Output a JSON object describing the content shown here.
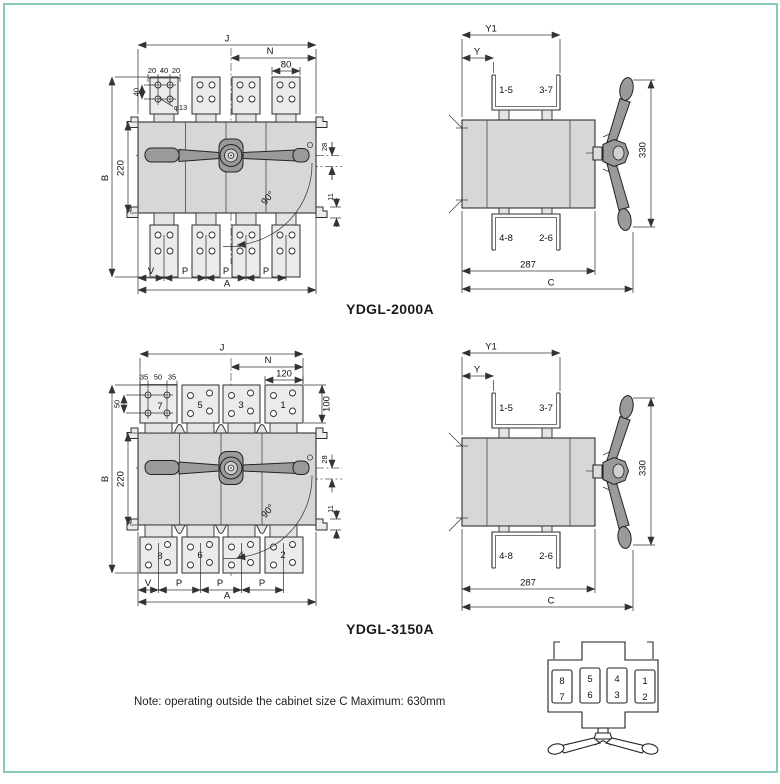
{
  "colors": {
    "frame": "#85cbb5",
    "body_fill": "#d7d7d7",
    "pad_fill": "#ebebeb",
    "handle_fill": "#9a9a9a",
    "line": "#333333"
  },
  "note": "Note: operating outside the cabinet size C Maximum: 630mm",
  "model_2000a": {
    "title": "YDGL-2000A",
    "front": {
      "j": "J",
      "n": "N",
      "w80": "80",
      "t20a": "20",
      "t40": "40",
      "t20b": "20",
      "v40": "40",
      "hole": "φ13",
      "b": "B",
      "h220": "220",
      "r28": "28",
      "angle": "90°",
      "r11": "11",
      "v": "V",
      "p1": "P",
      "p2": "P",
      "p3": "P",
      "a": "A"
    },
    "side": {
      "y1": "Y1",
      "y": "Y",
      "t15": "1-5",
      "t37": "3-7",
      "h330": "330",
      "b48": "4-8",
      "b26": "2-6",
      "w287": "287",
      "c": "C"
    }
  },
  "model_3150a": {
    "title": "YDGL-3150A",
    "front": {
      "j": "J",
      "n": "N",
      "w120": "120",
      "t35a": "35",
      "t50": "50",
      "t35b": "35",
      "v50": "50",
      "h100": "100",
      "b": "B",
      "h220": "220",
      "r28": "28",
      "angle": "90°",
      "r11": "11",
      "v": "V",
      "p1": "P",
      "p2": "P",
      "p3": "P",
      "a": "A",
      "poles_top": [
        "7",
        "5",
        "3",
        "1"
      ],
      "poles_bottom": [
        "8",
        "6",
        "4",
        "2"
      ]
    },
    "side": {
      "y1": "Y1",
      "y": "Y",
      "t15": "1-5",
      "t37": "3-7",
      "h330": "330",
      "b48": "4-8",
      "b26": "2-6",
      "w287": "287",
      "c": "C"
    }
  },
  "top_view": {
    "slots": [
      [
        "8",
        "7"
      ],
      [
        "5",
        "6"
      ],
      [
        "4",
        "3"
      ],
      [
        "1",
        "2"
      ]
    ]
  }
}
